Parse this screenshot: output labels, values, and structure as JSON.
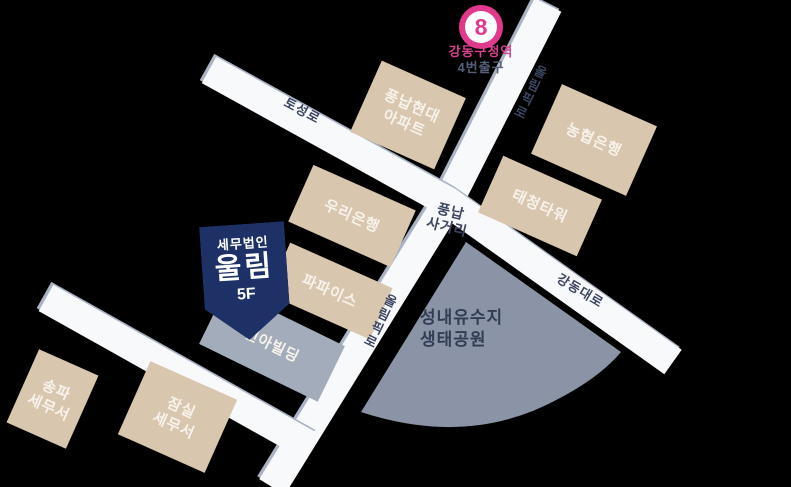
{
  "station": {
    "line": "8",
    "name": "강동구청역",
    "exit": "4번출구"
  },
  "roads": {
    "toseong": "토성로",
    "olympic": "올림픽로",
    "gangdong": "강동대로"
  },
  "intersection": {
    "line1": "풍납",
    "line2": "사거리"
  },
  "buildings": {
    "pungnap_hyundai": {
      "line1": "풍납현대",
      "line2": "아파트"
    },
    "nh_bank": "농협은행",
    "taecheong_tower": "태청타워",
    "woori_bank": "우리은행",
    "popeyes": "파파이스",
    "geona": "건아빌딩",
    "songpa_tax_office": {
      "line1": "송파",
      "line2": "세무서"
    },
    "jamsil_tax_office": {
      "line1": "잠실",
      "line2": "세무서"
    }
  },
  "marker": {
    "firm_type": "세무법인",
    "firm_name": "울림",
    "floor": "5F"
  },
  "park": {
    "line1": "성내유수지",
    "line2": "생태공원"
  },
  "colors": {
    "accent_pink": "#e13a8c",
    "marker_navy": "#1e3166",
    "building_beige": "#d9c6ae",
    "building_gray": "#a3acba",
    "park_gray": "#8a94a6",
    "road_white": "#f8f9fb",
    "label_navy": "#3d4660"
  }
}
